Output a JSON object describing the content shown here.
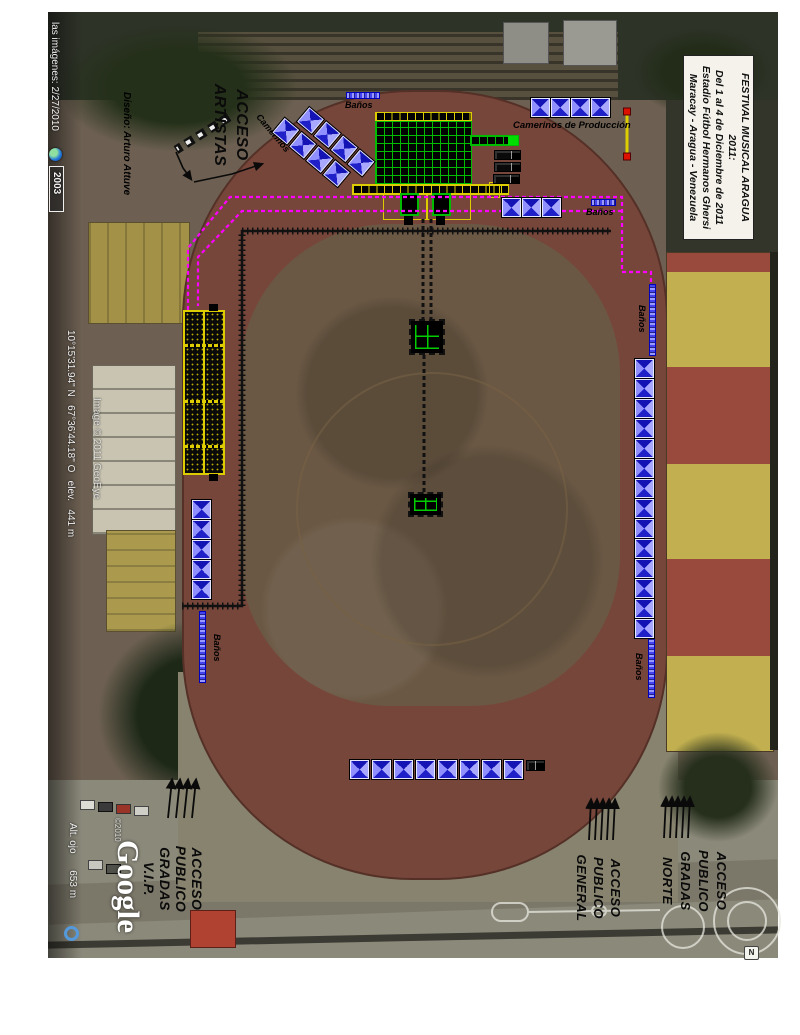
{
  "event": {
    "title_lines": [
      "FESTIVAL MUSICAL ARAGUA 2011:",
      "Del 1 al 4 de Diciembre de 2011",
      "Estadio Fútbol Hermanos Ghersi",
      "Maracay - Aragua - Venezuela"
    ]
  },
  "status_bar": {
    "imagery_date": "las imágenes: 2/27/2010",
    "time_badge": "2003",
    "coordinates": "10°15'31.94\" N   67°36'44.18\" O   elev.   441 m",
    "eye_altitude": "Alt. ojo      653 m"
  },
  "watermarks": {
    "imagery_credit": "Image © 2011 GeoEye",
    "copyright": "©2010",
    "logo": "Google"
  },
  "annotations": {
    "designer": "Diseño: Arturo Attuve",
    "acceso_artistas": [
      "ACCESO",
      "ARTISTAS"
    ],
    "camerinos": "Camerinos",
    "camerinos_produccion": "Camerinos de Producción",
    "banos": "Baños",
    "acceso_vip": [
      "ACCESO",
      "PUBLICO",
      "GRADAS",
      "V.I.P."
    ],
    "acceso_general": [
      "ACCESO",
      "PUBLICO",
      "GENERAL"
    ],
    "acceso_norte": [
      "ACCESO",
      "PUBLICO",
      "GRADAS",
      "NORTE"
    ],
    "compass": "N"
  },
  "tent_groups": {
    "camerinos_diagonal": {
      "rows": 2,
      "per_row": 4
    },
    "produccion_row": {
      "count": 4
    },
    "backstage_row": {
      "count": 3
    },
    "left_column": {
      "count": 5
    },
    "right_column": {
      "count": 14
    },
    "south_row": {
      "count": 8
    }
  },
  "vehicles": {
    "production_trucks": 3,
    "south_truck": 1
  },
  "colors": {
    "tent_blue": "#2020c8",
    "route_magenta": "#ff00ff",
    "stage_green": "#00bb00",
    "stage_yellow": "#ddcc00",
    "path_black": "#111111",
    "track_red": "#77463a",
    "field_dirt": "#6a5844"
  }
}
